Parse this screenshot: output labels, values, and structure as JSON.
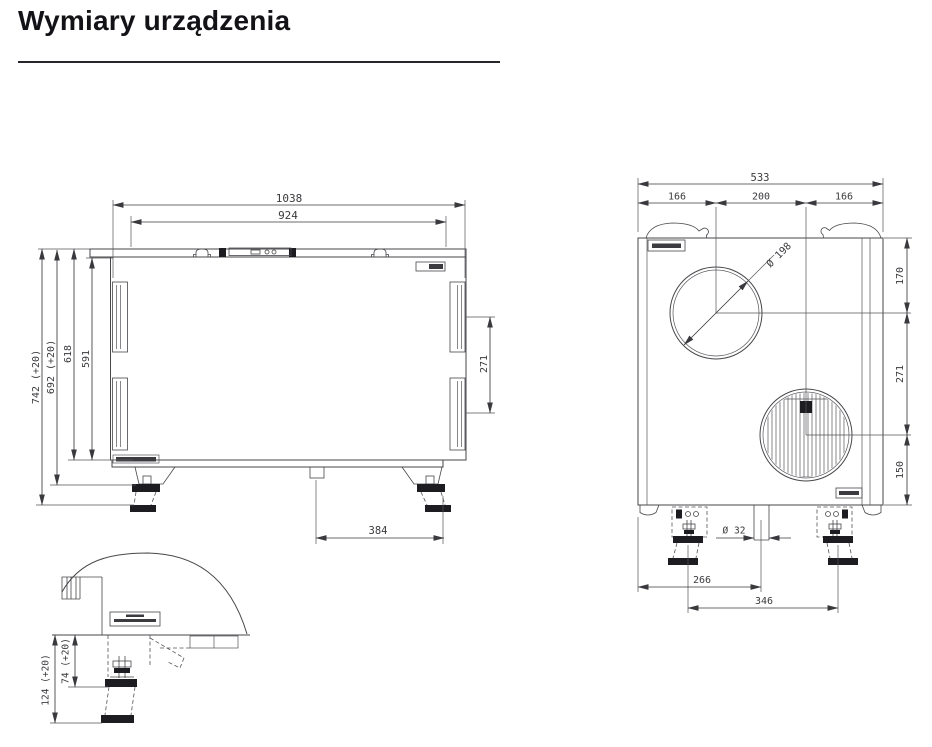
{
  "title": "Wymiary urządzenia",
  "front_view": {
    "width_overall": "1038",
    "width_body": "924",
    "height_max": "742 (+20)",
    "height_with_feet": "692 (+20)",
    "height_to_lid": "618",
    "height_body": "591",
    "duct_spacing": "271",
    "drain_to_foot": "384"
  },
  "side_view": {
    "depth_overall": "533",
    "seg_left": "166",
    "seg_center": "200",
    "seg_right": "166",
    "duct_diameter": "Ø 198",
    "top_to_duct": "170",
    "duct_spacing": "271",
    "duct_to_bottom": "150",
    "drain_diameter": "Ø 32",
    "edge_to_drain": "266",
    "foot_spacing": "346"
  },
  "detail_view": {
    "foot_min": "74 (+20)",
    "foot_max": "124 (+20)"
  }
}
